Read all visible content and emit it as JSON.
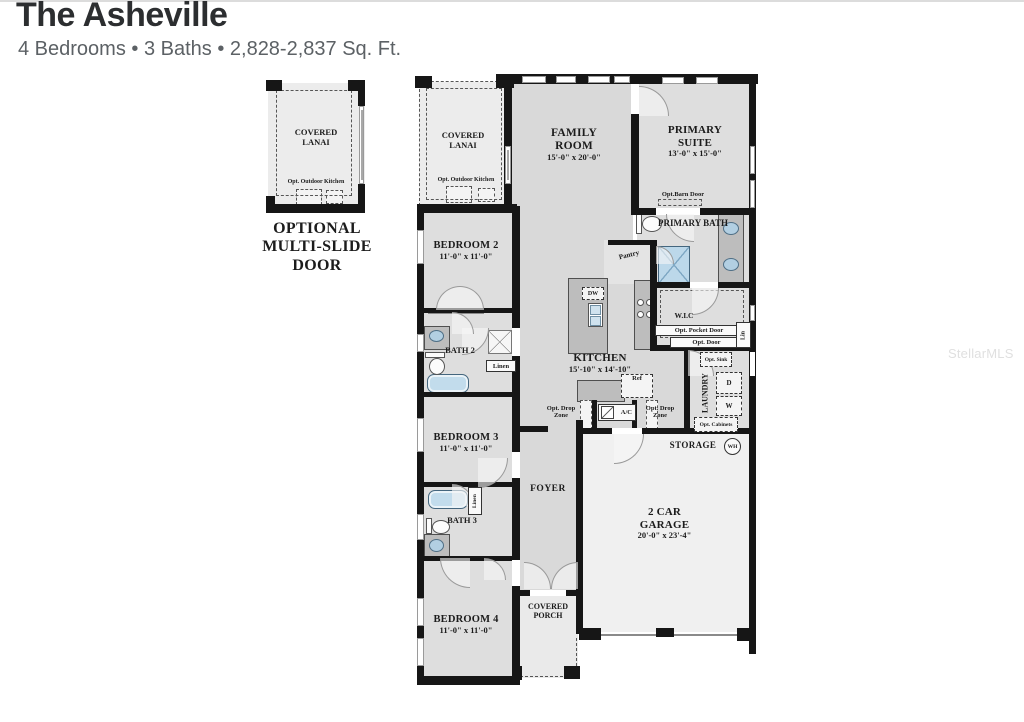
{
  "header": {
    "title": "The Asheville",
    "subtitle": "4 Bedrooms • 3 Baths • 2,828-2,837 Sq. Ft."
  },
  "watermark": "StellarMLS",
  "inset": {
    "room": "COVERED LANAI",
    "opt_kitchen": "Opt. Outdoor Kitchen",
    "caption": "OPTIONAL MULTI-SLIDE DOOR"
  },
  "plan": {
    "covered_lanai": {
      "name": "COVERED LANAI",
      "opt_kitchen": "Opt. Outdoor Kitchen"
    },
    "family_room": {
      "name": "FAMILY ROOM",
      "dims": "15'-0\" x 20'-0\""
    },
    "primary_suite": {
      "name": "PRIMARY SUITE",
      "dims": "13'-0\" x 15'-0\"",
      "opt_barn_door": "Opt.Barn Door"
    },
    "primary_bath": {
      "name": "PRIMARY BATH"
    },
    "pantry": {
      "name": "Pantry"
    },
    "wic": {
      "name": "W.I.C",
      "opt_pocket_door": "Opt. Pocket Door",
      "opt_door": "Opt. Door",
      "lin": "Lin"
    },
    "kitchen": {
      "name": "KITCHEN",
      "dims": "15'-10\" x 14'-10\"",
      "dw": "DW",
      "ref": "Ref"
    },
    "laundry": {
      "name": "LAUNDRY",
      "opt_sink": "Opt. Sink",
      "dryer": "D",
      "washer": "W",
      "opt_cabinets": "Opt. Cabinets"
    },
    "storage": {
      "name": "STORAGE",
      "wh": "WH"
    },
    "garage": {
      "name": "2 CAR GARAGE",
      "dims": "20'-0\" x 23'-4\""
    },
    "bedroom2": {
      "name": "BEDROOM 2",
      "dims": "11'-0\" x 11'-0\""
    },
    "bath2": {
      "name": "BATH 2",
      "linen": "Linen"
    },
    "bedroom3": {
      "name": "BEDROOM 3",
      "dims": "11'-0\" x 11'-0\""
    },
    "bath3": {
      "name": "BATH 3",
      "linen": "Linen"
    },
    "bedroom4": {
      "name": "BEDROOM 4",
      "dims": "11'-0\" x 11'-0\""
    },
    "foyer": {
      "name": "FOYER"
    },
    "covered_porch": {
      "name": "COVERED PORCH"
    },
    "hvac": {
      "name": "A/C"
    },
    "drop_zone_left": "Opt. Drop Zone",
    "drop_zone_right": "Opt. Drop Zone"
  }
}
